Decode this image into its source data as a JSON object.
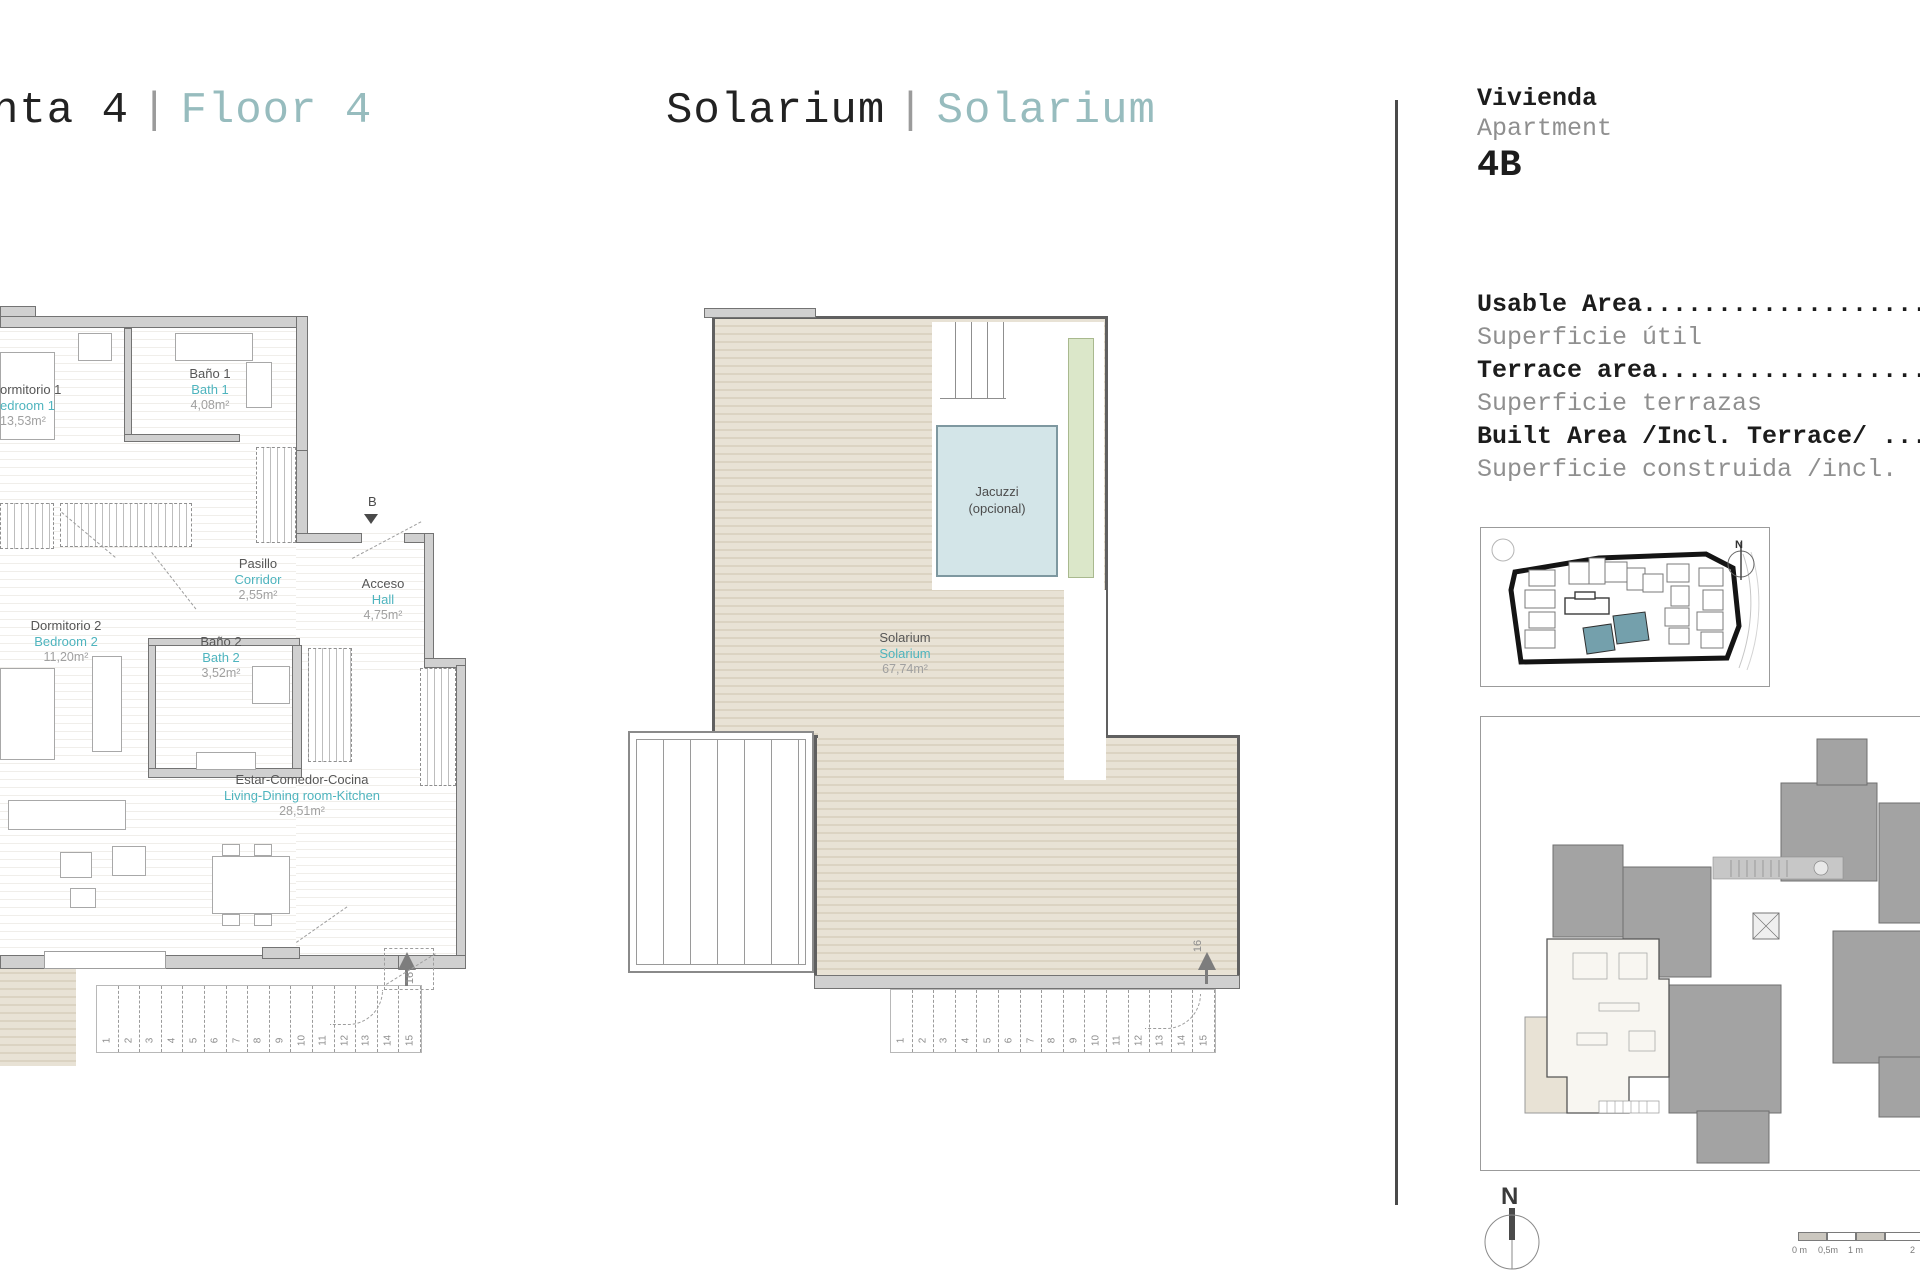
{
  "header": {
    "left_title": {
      "partial": "nta 4",
      "sep": "|",
      "en": "Floor 4"
    },
    "mid_title": {
      "es": "Solarium",
      "sep": "|",
      "en": "Solarium"
    }
  },
  "colors": {
    "title_teal": "#97bcbe",
    "label_teal": "#4eb4be",
    "wall_gray": "#d0d0d0",
    "deck_beige": "#e8e2d5",
    "jacuzzi_blue": "#d3e5e8",
    "planter_green": "#dbe7c9",
    "site_building_teal": "#74a0ac"
  },
  "floor4_plan": {
    "rooms": [
      {
        "es": "ormitorio 1",
        "en": "edroom 1",
        "area": "13,53m²"
      },
      {
        "es": "Baño 1",
        "en": "Bath 1",
        "area": "4,08m²"
      },
      {
        "es": "Pasillo",
        "en": "Corridor",
        "area": "2,55m²"
      },
      {
        "es": "Acceso",
        "en": "Hall",
        "area": "4,75m²"
      },
      {
        "es": "Dormitorio 2",
        "en": "Bedroom 2",
        "area": "11,20m²"
      },
      {
        "es": "Baño 2",
        "en": "Bath 2",
        "area": "3,52m²"
      },
      {
        "es": "Estar-Comedor-Cocina",
        "en": "Living-Dining room-Kitchen",
        "area": "28,51m²"
      }
    ],
    "section_marker": "B",
    "stair_numbers": [
      "1",
      "2",
      "3",
      "4",
      "5",
      "6",
      "7",
      "8",
      "9",
      "10",
      "11",
      "12",
      "13",
      "14",
      "15"
    ],
    "landing_number": "16"
  },
  "solarium_plan": {
    "room": {
      "es": "Solarium",
      "en": "Solarium",
      "area": "67,74m²"
    },
    "jacuzzi": {
      "line1": "Jacuzzi",
      "line2": "(opcional)"
    },
    "stair_numbers": [
      "1",
      "2",
      "3",
      "4",
      "5",
      "6",
      "7",
      "8",
      "9",
      "10",
      "11",
      "12",
      "13",
      "14",
      "15"
    ],
    "landing_number": "16"
  },
  "info_panel": {
    "unit_block": {
      "label_es": "Vivienda",
      "label_en": "Apartment",
      "unit": "4B"
    },
    "lines": [
      "Usable Area.............................",
      "Superficie útil",
      "Terrace area............................",
      "Superficie terrazas",
      "Built Area /Incl. Terrace/ .............",
      "Superficie construida /incl. "
    ],
    "site_map_north": "N",
    "compass_north": "N",
    "scale_labels": [
      "0 m",
      "0,5m",
      "1 m",
      "2"
    ]
  }
}
